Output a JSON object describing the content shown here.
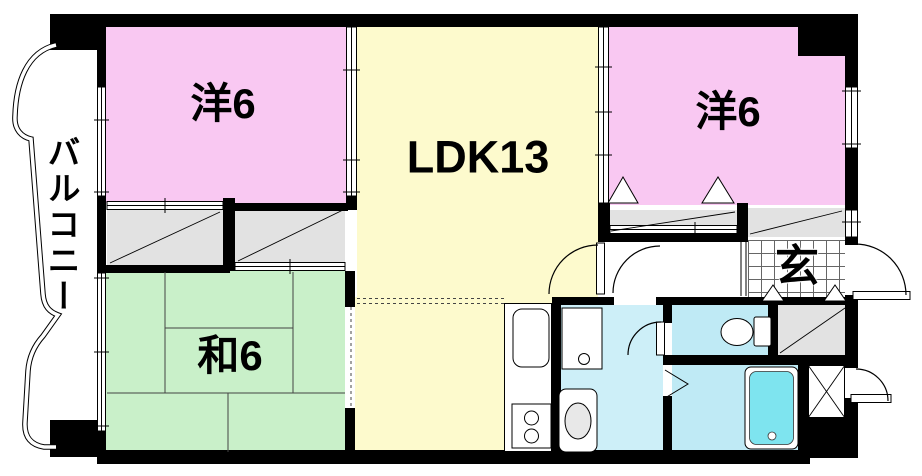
{
  "plan": {
    "type": "apartment-floorplan",
    "rooms": {
      "bedroom_left": {
        "label": "洋6"
      },
      "ldk": {
        "label": "LDK13"
      },
      "bedroom_right": {
        "label": "洋6"
      },
      "tatami": {
        "label": "和6"
      },
      "balcony": {
        "label": "バルコニー"
      },
      "entrance": {
        "label": "玄"
      }
    },
    "fixtures": [
      "kitchen-sink",
      "gas-stove",
      "washing-machine-pan",
      "washbasin",
      "toilet",
      "bathtub"
    ],
    "palette": {
      "bedroom": "#f9c8f2",
      "ldk": "#fdfacd",
      "tatami": "#c9f0c9",
      "wet_area": "#bfeaf5",
      "washroom": "#cdeff8",
      "bathtub": "#7ee4ef",
      "closet": "#e2e2e2",
      "wall": "#000000"
    }
  }
}
